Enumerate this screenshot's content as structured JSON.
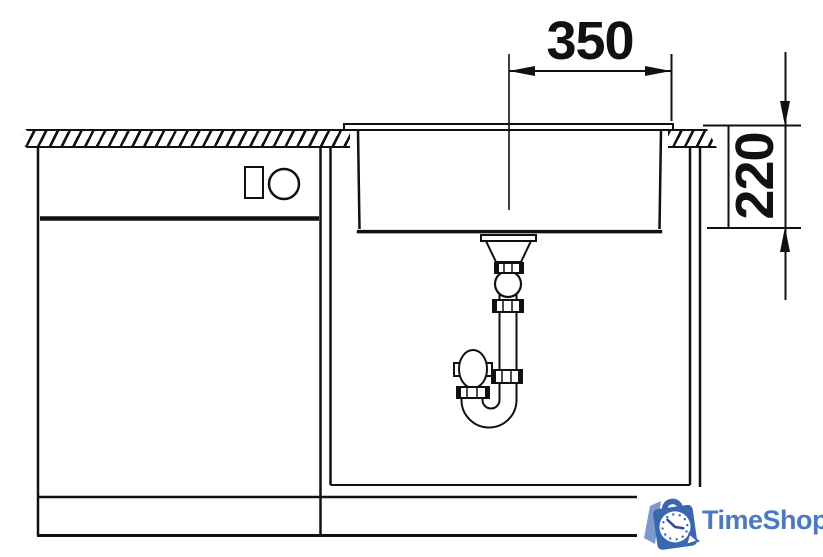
{
  "diagram": {
    "background_color": "#ffffff",
    "line_color": "#111111",
    "width_dimension": "350",
    "depth_dimension": "220"
  },
  "logo": {
    "name": "TimeShop",
    "icons": [
      "shopping-bag-icon",
      "clock-icon"
    ],
    "text_color": "#4d79c1",
    "bag_color": "#3b67b0",
    "flap_color": "#7d98ca",
    "accent_color": "#2d4f96",
    "clock_face_color": "#ffffff"
  }
}
